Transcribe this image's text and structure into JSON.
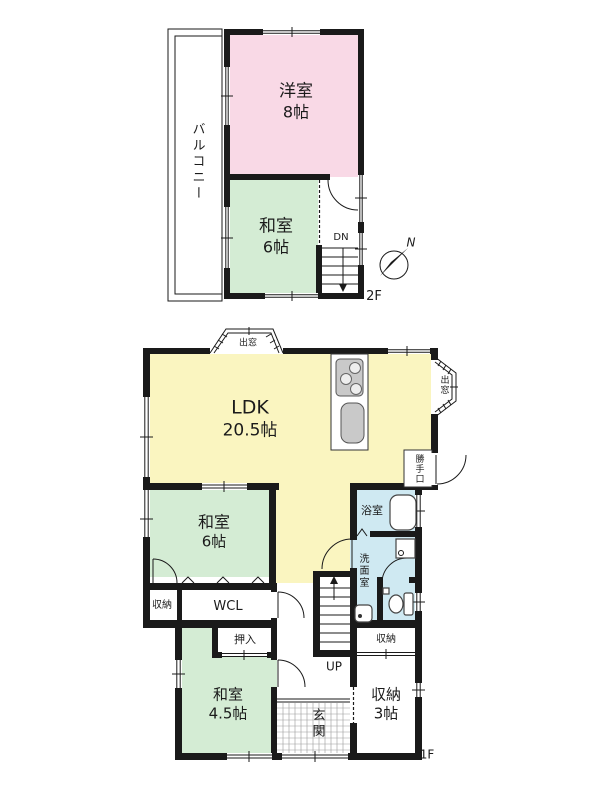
{
  "floor2": {
    "floor_label": "2F",
    "balcony_label": "バルコニー",
    "western_room": {
      "name": "洋室",
      "size": "8帖"
    },
    "japanese_room": {
      "name": "和室",
      "size": "6帖"
    },
    "stairs_label": "DN",
    "compass_label": "N"
  },
  "floor1": {
    "floor_label": "1F",
    "ldk": {
      "name": "LDK",
      "size": "20.5帖"
    },
    "bay_window_top_label": "出窓",
    "bay_window_right_label": "出窓",
    "back_door_label": "勝手口",
    "bath_label": "浴室",
    "washroom_label": "洗面室",
    "japanese_room_6": {
      "name": "和室",
      "size": "6帖"
    },
    "storage_label_left": "収納",
    "wcl_label": "WCL",
    "closet_label": "押入",
    "japanese_room_45": {
      "name": "和室",
      "size": "4.5帖"
    },
    "stairs_label": "UP",
    "entrance_label": "玄関",
    "storage_label_right": "収納",
    "storage_room_3": {
      "name": "収納",
      "size": "3帖"
    }
  },
  "colors": {
    "wall": "#1a1a1a",
    "western_room_fill": "#f9d9e6",
    "japanese_room_fill": "#d4ecd4",
    "ldk_fill": "#faf5c0",
    "wet_area_fill": "#cfe9f2",
    "fixture_gray": "#c9c9c9"
  }
}
